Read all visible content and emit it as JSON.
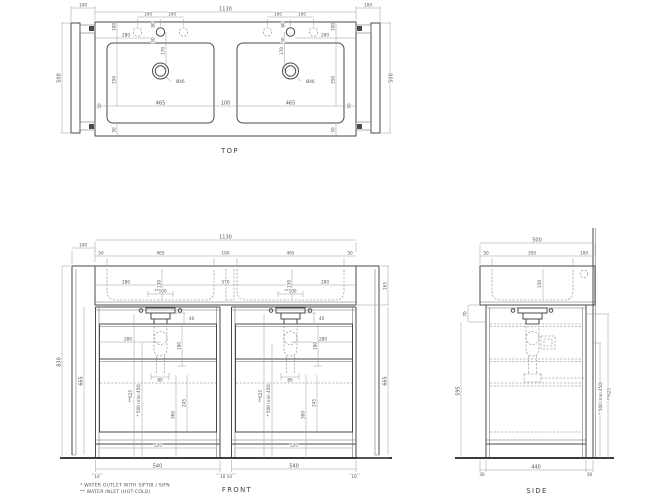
{
  "page": {
    "background": "#ffffff",
    "line_color": "#4a4a4a",
    "dim_color": "#9a9a9a",
    "text_color": "#555555"
  },
  "top_view": {
    "label": "TOP",
    "dims": {
      "wall_gap": "100",
      "total_width": "1130",
      "depth": "500",
      "faucet_spacing": "100",
      "faucet_offset": "80",
      "faucet_drop": "50",
      "back_offset": "100",
      "faucet_inset": "280",
      "faucet_to_drain": "170",
      "basin_depth": "350",
      "drain_diameter": "Ø46",
      "edge_gap": "50",
      "basin_width": "465",
      "basin_gap": "100",
      "front_gap": "50"
    }
  },
  "front_view": {
    "label": "FRONT",
    "dims": {
      "wall_gap": "100",
      "total_width": "1130",
      "edge_gap": "50",
      "basin_width": "465",
      "basin_gap": "100",
      "basin_height": "150",
      "counter_inset": "280",
      "center_spacing": "570",
      "inlet_width": "**100",
      "counter_height": "165",
      "total_height": "830",
      "cabinet_height": "665",
      "trap_drop": "40",
      "trap_inset": "280",
      "drawer_top_height": "180",
      "inlet_height": "**625",
      "outlet_height": "* 500 (min 450)",
      "drain_height": "360",
      "drain_span": "245",
      "trap_width": "80",
      "drawer_width": "520",
      "cabinet_width": "540",
      "leg_inset": "10",
      "leg_gap": "10 10"
    }
  },
  "side_view": {
    "label": "SIDE",
    "dims": {
      "total_depth": "500",
      "front_gap": "50",
      "basin_depth": "350",
      "back_gap": "100",
      "basin_height": "150",
      "rail_height": "70",
      "interior_height": "595",
      "outlet_height": "* 500 (min 450)",
      "inlet_height": "**625",
      "floor_depth": "440",
      "front_overhang": "30",
      "back_overhang": "30"
    }
  },
  "footnotes": {
    "outlet": "*  WATER OUTLET WITH SIFTIB / SIFN",
    "inlet": "** WATER INLET (HOT-COLD)"
  }
}
